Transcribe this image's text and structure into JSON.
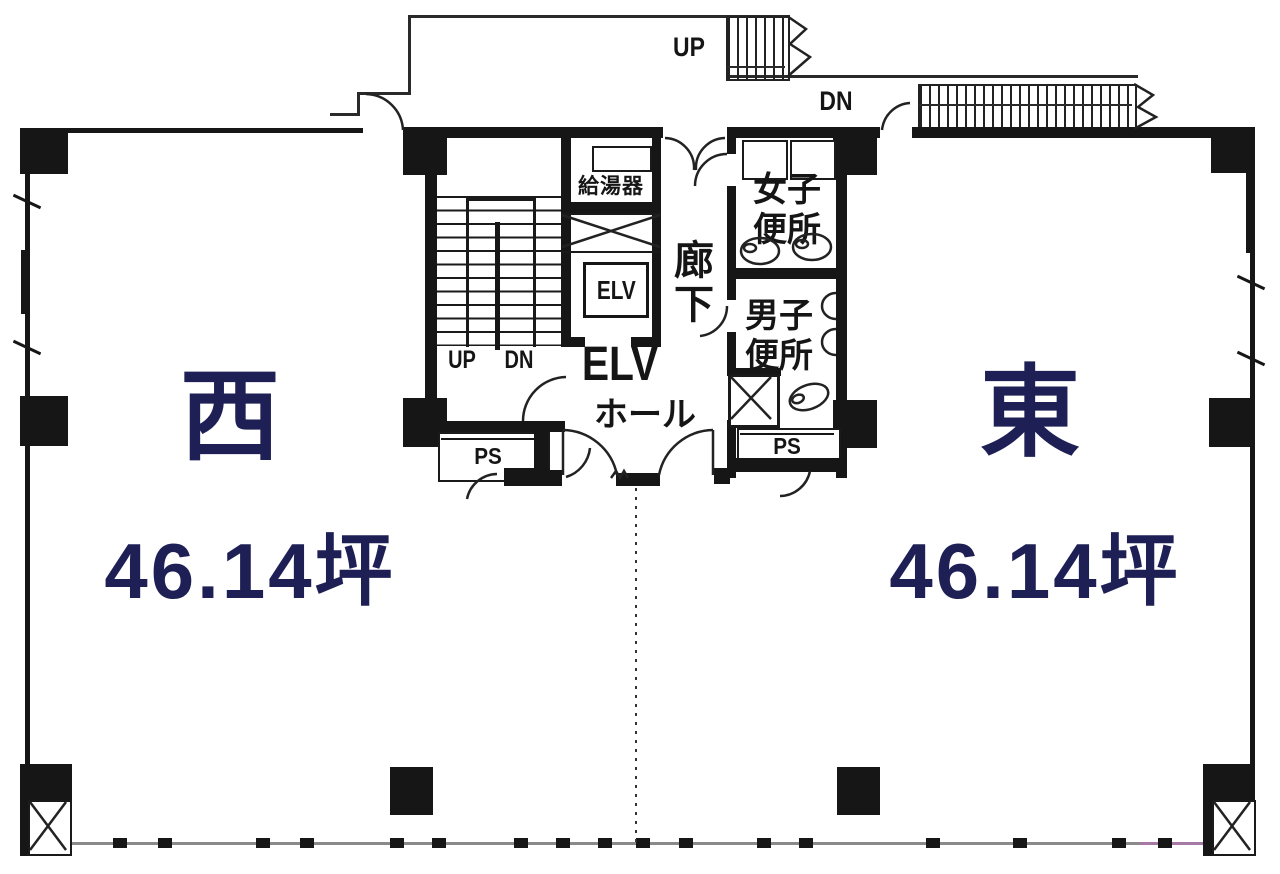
{
  "title": "floor-plan",
  "colors": {
    "wall": "#161616",
    "tenant_text_navy": "#1e2055",
    "room_text": "#151515",
    "window_line": "#8a8a8a",
    "window_line_right": "#a578a5"
  },
  "rooms": {
    "west": {
      "name": "西",
      "area": "46.14坪"
    },
    "east": {
      "name": "東",
      "area": "46.14坪"
    }
  },
  "labels": {
    "corridor": "廊下",
    "water_heater": "給湯器",
    "elevator_shaft": "ELV",
    "elevator_hall_line1": "ELV",
    "elevator_hall_line2": "ホール",
    "pipe_space_left": "PS",
    "pipe_space_right": "PS",
    "womens_toilet_line1": "女子",
    "womens_toilet_line2": "便所",
    "mens_toilet_line1": "男子",
    "mens_toilet_line2": "便所",
    "stair_up": "UP",
    "stair_down": "DN",
    "exterior_stair_up": "UP",
    "exterior_stair_down": "DN"
  }
}
